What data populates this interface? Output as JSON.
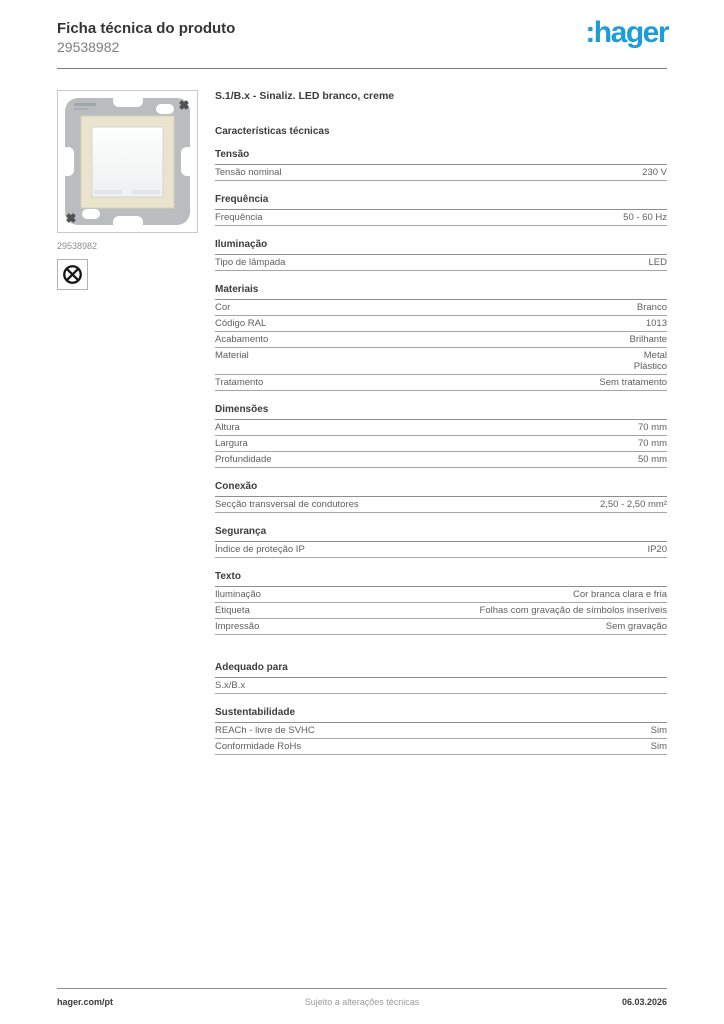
{
  "header": {
    "title": "Ficha técnica do produto",
    "product_code": "29538982",
    "brand_logo": ":hager",
    "brand_color": "#1e9cd7"
  },
  "product": {
    "title": "S.1/B.x - Sinaliz. LED branco, creme",
    "image_caption": "29538982",
    "image_description": "lamp-signal-insert-photo",
    "lamp_symbol_icon": "crossed-circle-lamp-symbol",
    "colors": {
      "plate_gray": "#b9bdc0",
      "frame_cream": "#eae3cd",
      "center_white": "#f7f9f9"
    }
  },
  "specs": {
    "heading": "Características técnicas",
    "sections": [
      {
        "title": "Tensão",
        "rows": [
          {
            "label": "Tensão nominal",
            "value": "230 V"
          }
        ]
      },
      {
        "title": "Frequência",
        "rows": [
          {
            "label": "Frequência",
            "value": "50 - 60 Hz"
          }
        ]
      },
      {
        "title": "Iluminação",
        "rows": [
          {
            "label": "Tipo de lâmpada",
            "value": "LED"
          }
        ]
      },
      {
        "title": "Materiais",
        "rows": [
          {
            "label": "Cor",
            "value": "Branco"
          },
          {
            "label": "Código RAL",
            "value": "1013"
          },
          {
            "label": "Acabamento",
            "value": "Brilhante"
          },
          {
            "label": "Material",
            "value": "Metal\nPlástico"
          },
          {
            "label": "Tratamento",
            "value": "Sem tratamento"
          }
        ]
      },
      {
        "title": "Dimensões",
        "rows": [
          {
            "label": "Altura",
            "value": "70 mm"
          },
          {
            "label": "Largura",
            "value": "70 mm"
          },
          {
            "label": "Profundidade",
            "value": "50 mm"
          }
        ]
      },
      {
        "title": "Conexão",
        "rows": [
          {
            "label": "Secção transversal de condutores",
            "value": "2,50 - 2,50 mm²"
          }
        ]
      },
      {
        "title": "Segurança",
        "rows": [
          {
            "label": "Índice de proteção IP",
            "value": "IP20"
          }
        ]
      },
      {
        "title": "Texto",
        "rows": [
          {
            "label": "Iluminação",
            "value": "Cor branca clara e fria"
          },
          {
            "label": "Etiqueta",
            "value": "Folhas com gravação de símbolos inseríveis"
          },
          {
            "label": "Impressão",
            "value": "Sem gravação"
          }
        ]
      },
      {
        "title": "Adequado para",
        "extra_gap": true,
        "rows": [
          {
            "label": "S.x/B.x",
            "value": ""
          }
        ]
      },
      {
        "title": "Sustentabilidade",
        "rows": [
          {
            "label": "REACh - livre de SVHC",
            "value": "Sim"
          },
          {
            "label": "Conformidade RoHs",
            "value": "Sim"
          }
        ]
      }
    ]
  },
  "footer": {
    "website": "hager.com/pt",
    "note": "Sujeito a alterações técnicas",
    "date": "06.03.2026"
  }
}
